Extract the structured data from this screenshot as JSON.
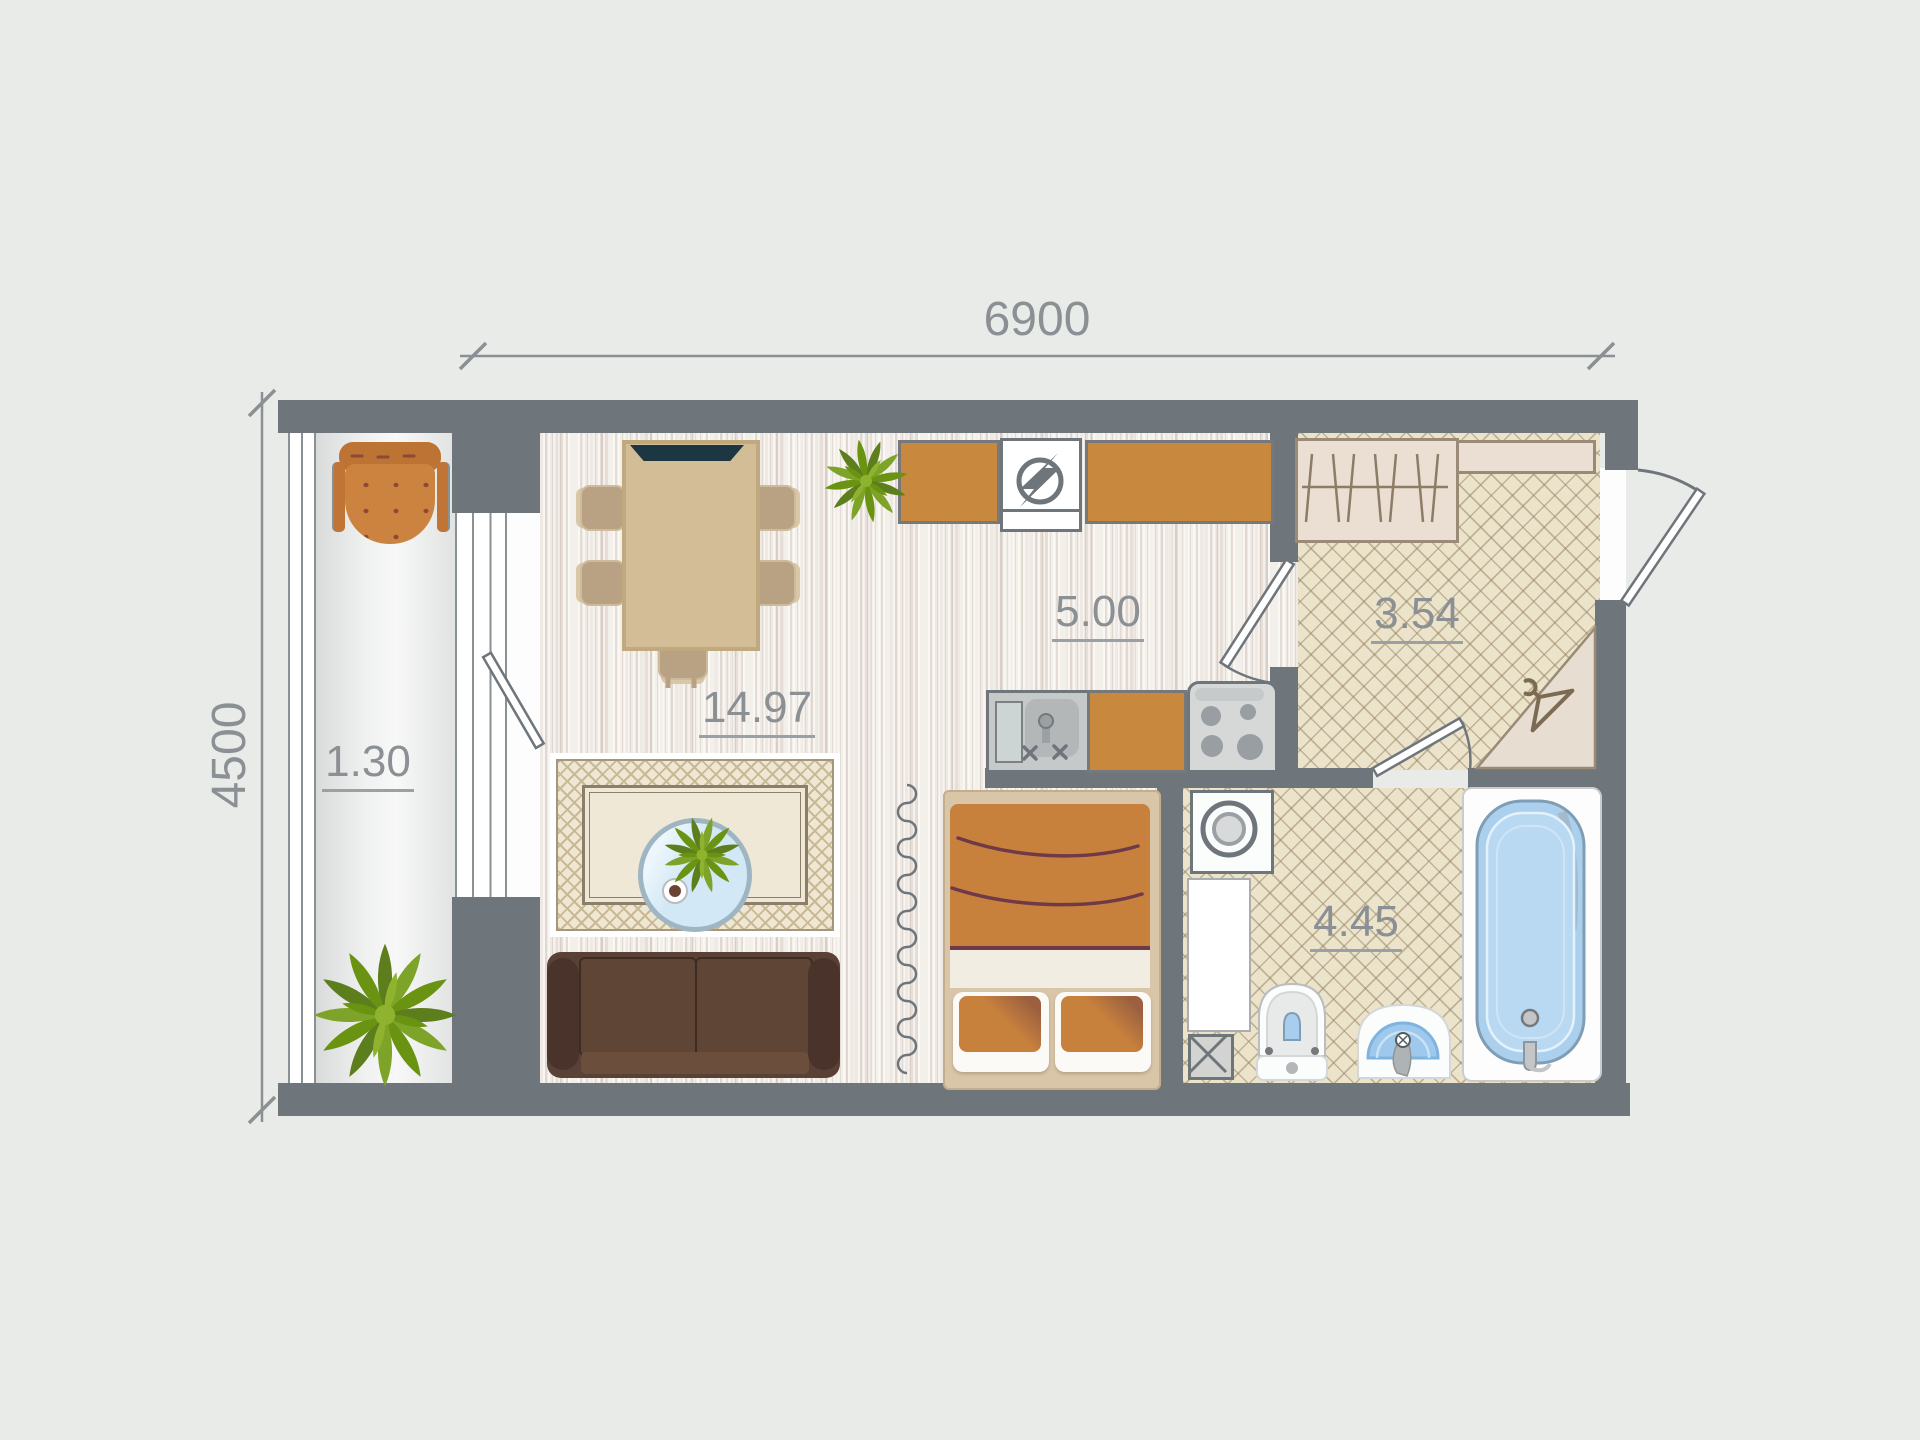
{
  "title": "studio apartment floor plan",
  "dimensions": {
    "top": "6900",
    "left": "4500"
  },
  "rooms": [
    {
      "id": "living-room",
      "label": "14.97"
    },
    {
      "id": "kitchen",
      "label": "5.00"
    },
    {
      "id": "hallway",
      "label": "3.54"
    },
    {
      "id": "bathroom",
      "label": "4.45"
    },
    {
      "id": "balcony",
      "label": "1.30"
    }
  ],
  "icons": {
    "fridge": "circled-lightning-bolt",
    "washing_machine": "concentric-drum-circles",
    "coat_corner": "clothes-hanger",
    "stove": "four-burner-cooktop",
    "duct_shaft": "crossed-box"
  },
  "palette": {
    "background": "#e9ebe8",
    "wall": "#6e757b",
    "dimension_text": "#8b9094",
    "wood_floor": "#efe9e4",
    "tile_floor": "#ece3cb",
    "counter_orange": "#c8883e",
    "sofa_brown": "#563e31",
    "bed_blanket": "#c8813d",
    "bath_blue": "#abd0ed",
    "plant_green": "#7da328"
  }
}
